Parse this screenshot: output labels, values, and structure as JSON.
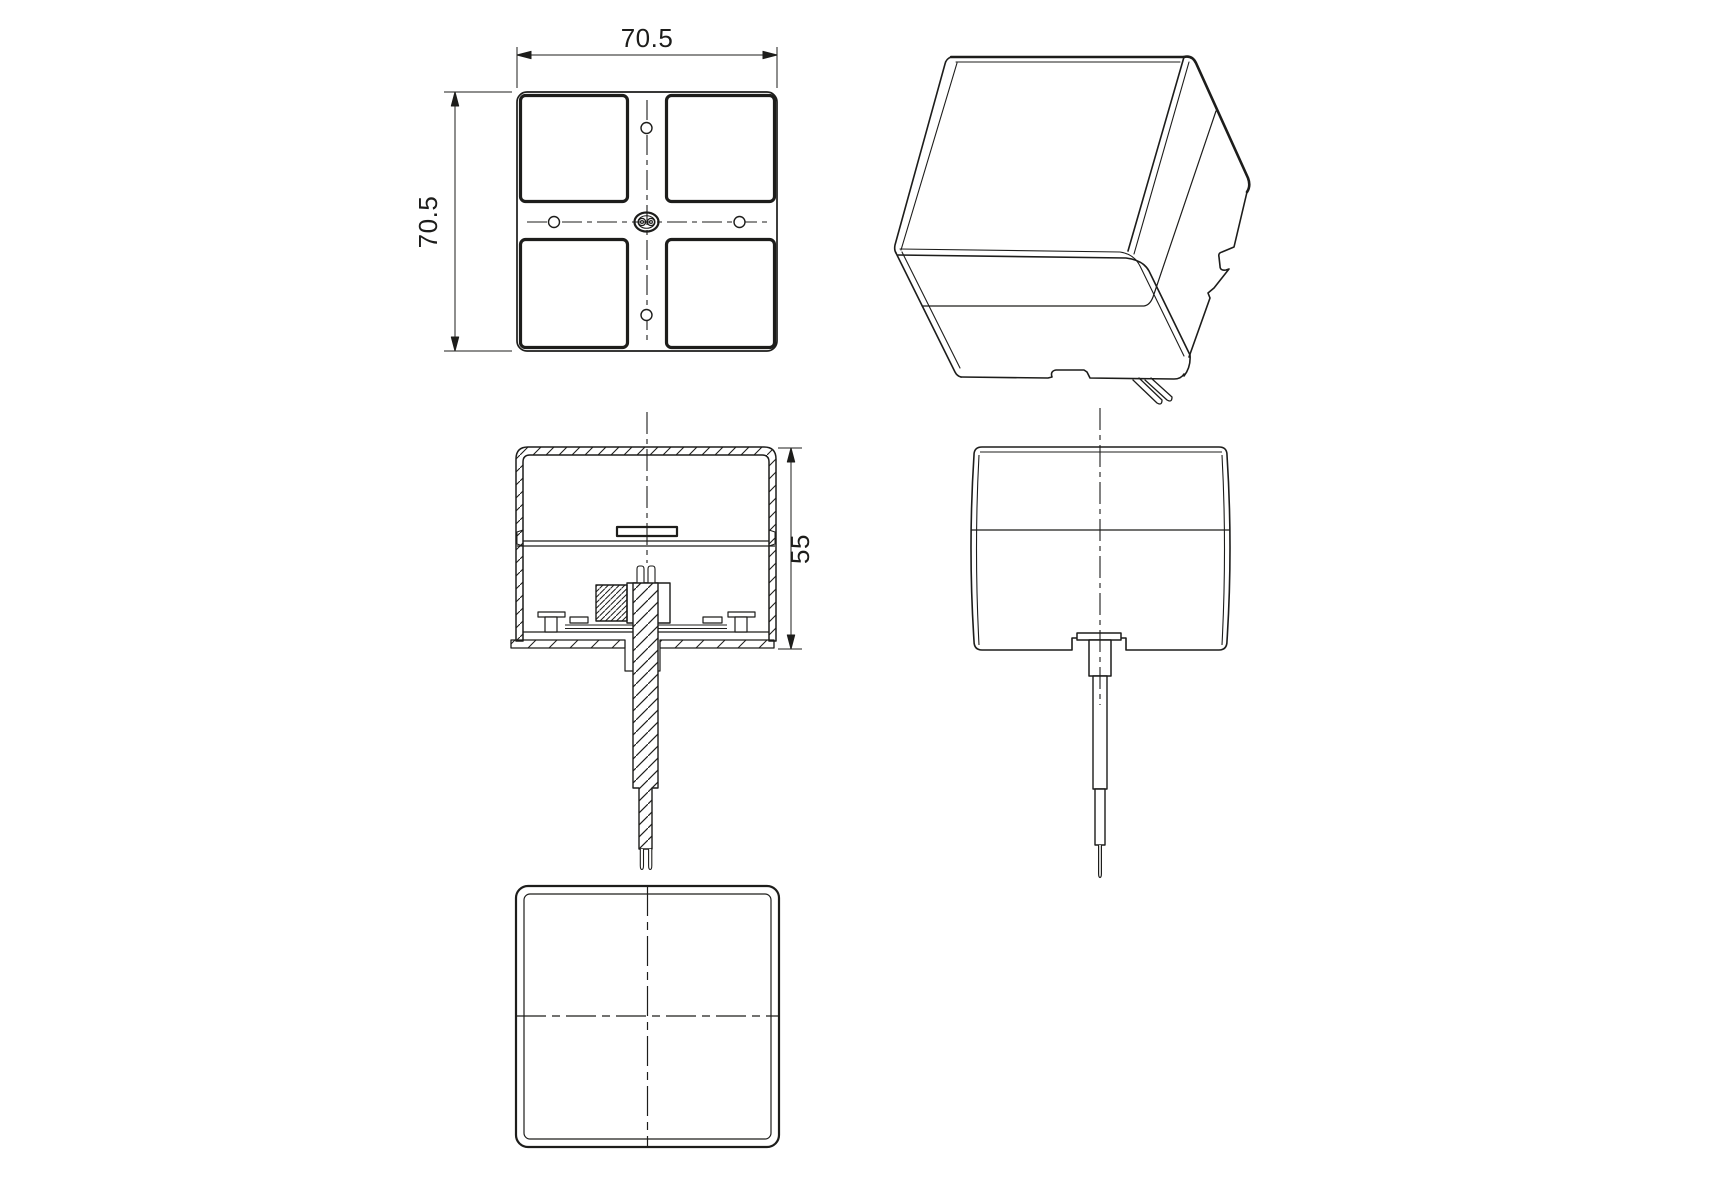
{
  "page": {
    "background": "#ffffff",
    "line_color": "#1d1d1b"
  },
  "dimensions": {
    "top_width": "70.5",
    "left_height": "70.5",
    "depth": "55"
  }
}
